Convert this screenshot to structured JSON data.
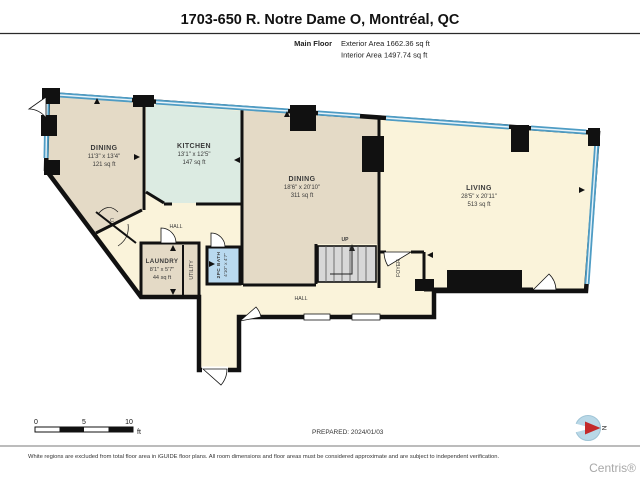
{
  "header": {
    "title": "1703-650 R. Notre Dame O, Montréal, QC",
    "floor_label": "Main Floor",
    "exterior_area_label": "Exterior Area 1662.36 sq ft",
    "interior_area_label": "Interior Area 1497.74 sq ft"
  },
  "plan": {
    "rooms": [
      {
        "name": "DINING",
        "dims": "11'3\" x 13'4\"",
        "area": "121 sq ft"
      },
      {
        "name": "KITCHEN",
        "dims": "13'1\" x 12'5\"",
        "area": "147 sq ft"
      },
      {
        "name": "DINING",
        "dims": "18'6\" x 20'10\"",
        "area": "311 sq ft"
      },
      {
        "name": "LIVING",
        "dims": "28'5\" x 20'11\"",
        "area": "513 sq ft"
      },
      {
        "name": "LAUNDRY",
        "dims": "8'1\" x 5'7\"",
        "area": "44 sq ft"
      },
      {
        "name": "2PC BATH",
        "dims": "4'10\" x 4'7\""
      }
    ],
    "labels": {
      "hall_upper": "HALL",
      "hall_lower": "HALL",
      "utility": "UTILITY",
      "foyer": "FOYER",
      "up": "UP",
      "closet": "C"
    },
    "colors": {
      "room_tan": "#e4dac6",
      "room_mint": "#dcebe2",
      "room_cream": "#faf3da",
      "room_blue": "#b9d9ef",
      "window_blue": "#4e9cc4",
      "wall": "#111111"
    }
  },
  "footer": {
    "scale": {
      "tick0": "0",
      "tick5": "5",
      "tick10": "10",
      "unit": "ft"
    },
    "prepared": "PREPARED: 2024/01/03",
    "compass_label": "N",
    "disclaimer": "White regions are excluded from total floor area in iGUIDE floor plans. All room dimensions and floor areas must be considered approximate and are subject to independent verification.",
    "brand": "Centris®"
  }
}
